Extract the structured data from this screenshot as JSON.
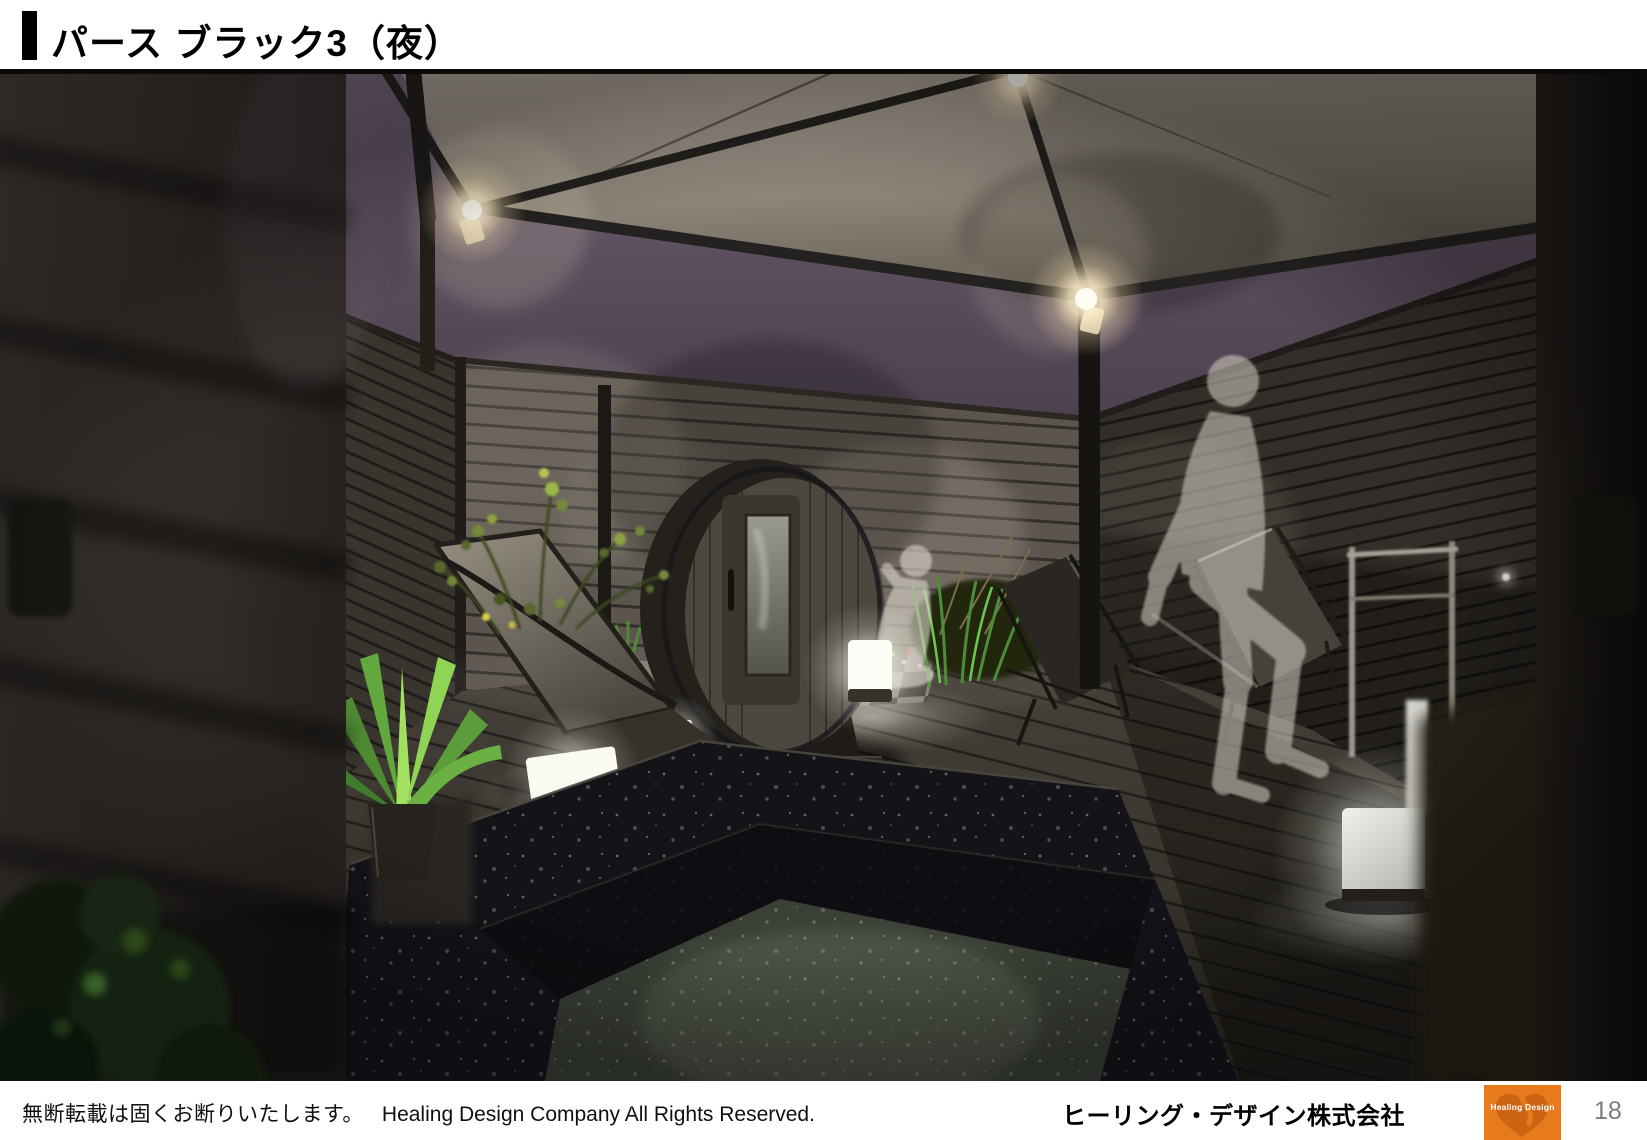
{
  "slide": {
    "title": "パース ブラック3（夜）",
    "page_number": "18"
  },
  "footer": {
    "notice_jp": "無断転載は固くお断りいたします。",
    "copyright_en": "Healing Design Company All Rights Reserved.",
    "company_name": "ヒーリング・デザイン株式会社",
    "logo_text": "Healing Design"
  },
  "render": {
    "caption": "Night-time 3D perspective rendering of a private black-themed garden spa terrace",
    "elements": [
      "night-sky",
      "gazebo-canopy",
      "canopy-lights",
      "slatted-fence",
      "wood-deck",
      "barrel-sauna",
      "stone-hot-tub",
      "lounge-chair",
      "deck-chairs",
      "agave-plant",
      "fern-plants",
      "ornamental-grass",
      "sitting-person-silhouette",
      "walking-person-silhouette",
      "cube-lanterns",
      "towel-rack",
      "tile-floor"
    ],
    "colors": {
      "sky_purple": "#5d4f5c",
      "canopy_fabric": "#948b80",
      "fence_gray": "#4e4943",
      "deck_wood": "#3f3a33",
      "hot_tub_stone": "#17161a",
      "plant_green": "#6ab042",
      "lantern_glow": "#fff8e6",
      "logo_orange": "#e87a1e",
      "page_number_gray": "#7d7d7d"
    }
  }
}
